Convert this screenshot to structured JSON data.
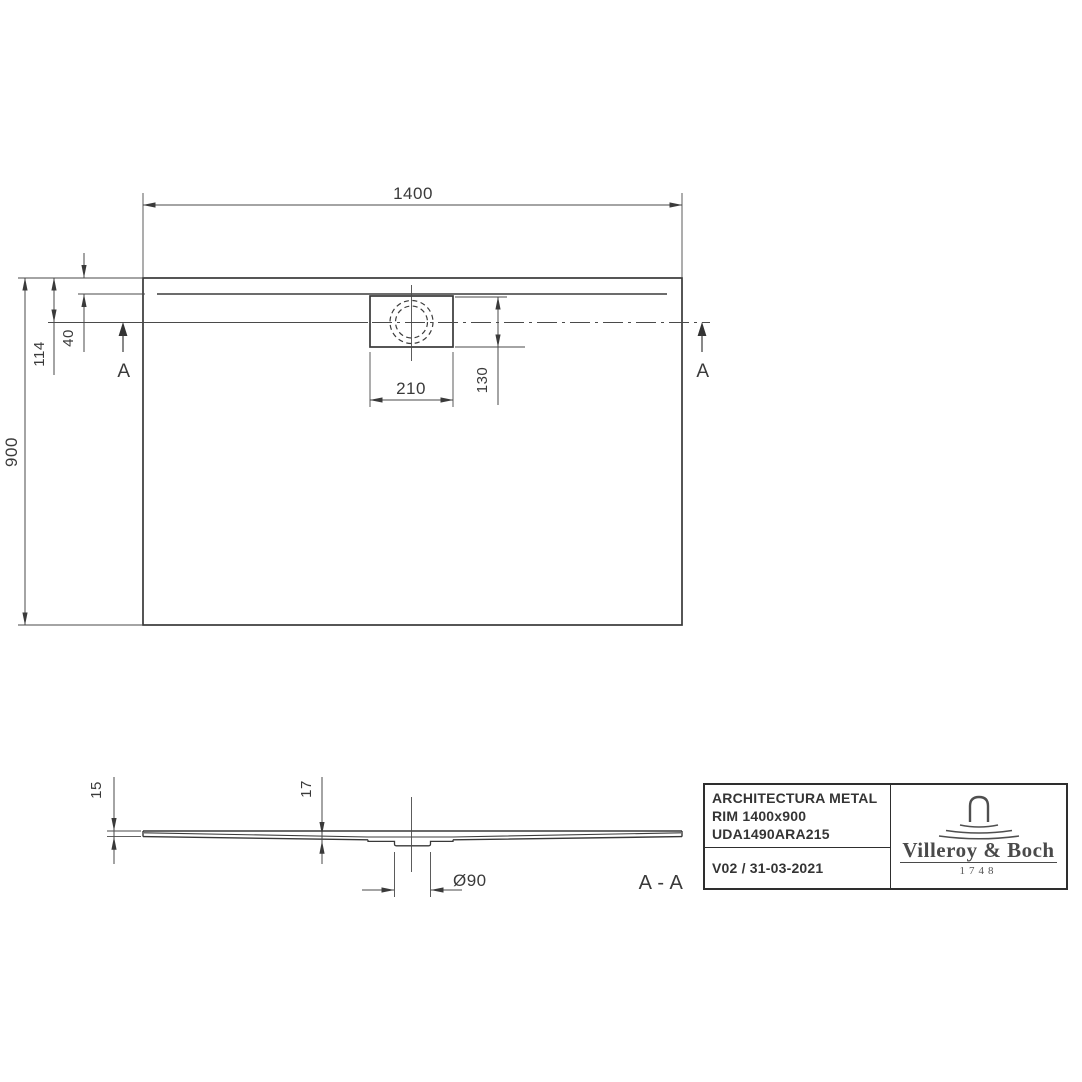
{
  "plan": {
    "dim_width": "1400",
    "dim_height": "900",
    "dim_drain_center_from_edge": "114",
    "dim_rim_offset": "40",
    "dim_drain_cutout_width": "210",
    "dim_drain_cutout_height": "130",
    "section_marker_left": "A",
    "section_marker_right": "A"
  },
  "section": {
    "dim_edge_thickness": "15",
    "dim_mid_thickness": "17",
    "dim_drain_diameter": "Ø90",
    "label": "A - A"
  },
  "title_block": {
    "product": "ARCHITECTURA METAL",
    "variant": "RIM 1400x900",
    "article": "UDA1490ARA215",
    "version_date": "V02 / 31-03-2021",
    "brand_name": "Villeroy & Boch",
    "brand_year": "1748"
  }
}
